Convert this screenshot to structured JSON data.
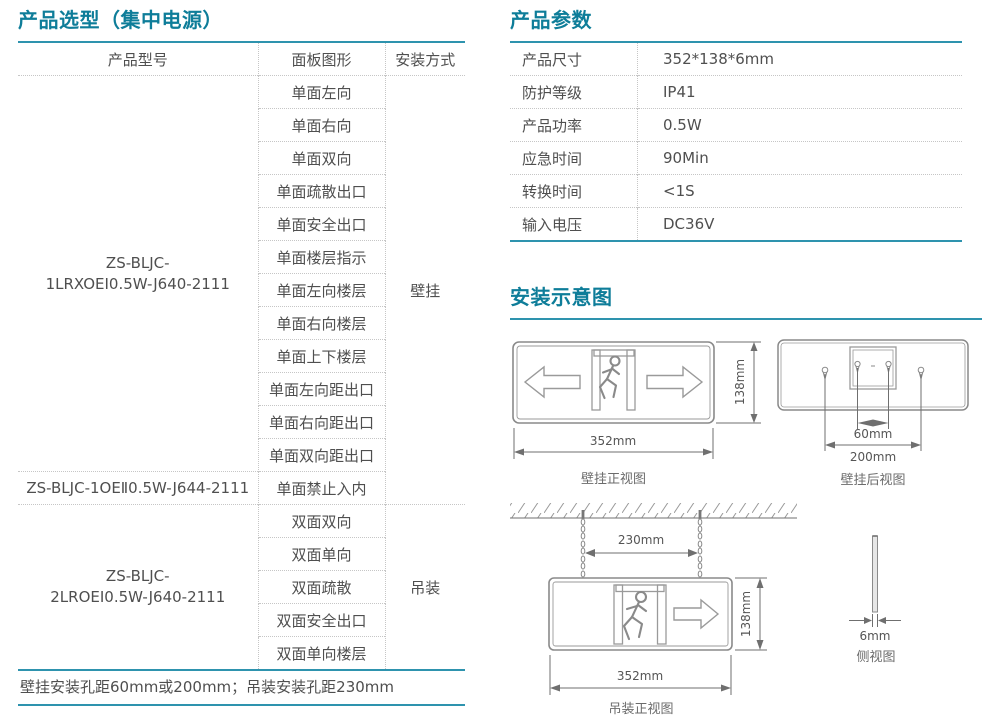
{
  "colors": {
    "title_accent": "#0e7d99",
    "rule_accent": "#2e93ae"
  },
  "left": {
    "title": "产品选型（集中电源）",
    "table": {
      "headers": [
        "产品型号",
        "面板图形",
        "安装方式"
      ],
      "models": [
        {
          "start": 0,
          "span": 12,
          "lines": [
            "ZS-BLJC-",
            "1LRXOEⅠ0.5W-J640-2111"
          ]
        },
        {
          "start": 12,
          "span": 1,
          "lines": [
            "ZS-BLJC-1OEⅡ0.5W-J644-2111"
          ]
        },
        {
          "start": 13,
          "span": 5,
          "lines": [
            "ZS-BLJC-",
            "2LROEⅠ0.5W-J640-2111"
          ]
        }
      ],
      "panel_rows": [
        "单面左向",
        "单面右向",
        "单面双向",
        "单面疏散出口",
        "单面安全出口",
        "单面楼层指示",
        "单面左向楼层",
        "单面右向楼层",
        "单面上下楼层",
        "单面左向距出口",
        "单面右向距出口",
        "单面双向距出口",
        "单面禁止入内",
        "双面双向",
        "双面单向",
        "双面疏散",
        "双面安全出口",
        "双面单向楼层"
      ],
      "mounts": [
        {
          "start": 0,
          "span": 13,
          "label": "壁挂"
        },
        {
          "start": 13,
          "span": 5,
          "label": "吊装"
        }
      ]
    },
    "footer": "壁挂安装孔距60mm或200mm；吊装安装孔距230mm"
  },
  "params": {
    "title": "产品参数",
    "rows": [
      {
        "label": "产品尺寸",
        "value": "352*138*6mm"
      },
      {
        "label": "防护等级",
        "value": "IP41"
      },
      {
        "label": "产品功率",
        "value": "0.5W"
      },
      {
        "label": "应急时间",
        "value": "90Min"
      },
      {
        "label": "转换时间",
        "value": "<1S"
      },
      {
        "label": "输入电压",
        "value": "DC36V"
      }
    ]
  },
  "install": {
    "title": "安装示意图",
    "front": {
      "width": "352mm",
      "height": "138mm",
      "caption": "壁挂正视图"
    },
    "back": {
      "pitch_inner": "60mm",
      "pitch_outer": "200mm",
      "caption": "壁挂后视图"
    },
    "hang": {
      "pitch": "230mm",
      "width": "352mm",
      "height": "138mm",
      "caption": "吊装正视图"
    },
    "side": {
      "thickness": "6mm",
      "caption": "侧视图"
    }
  }
}
